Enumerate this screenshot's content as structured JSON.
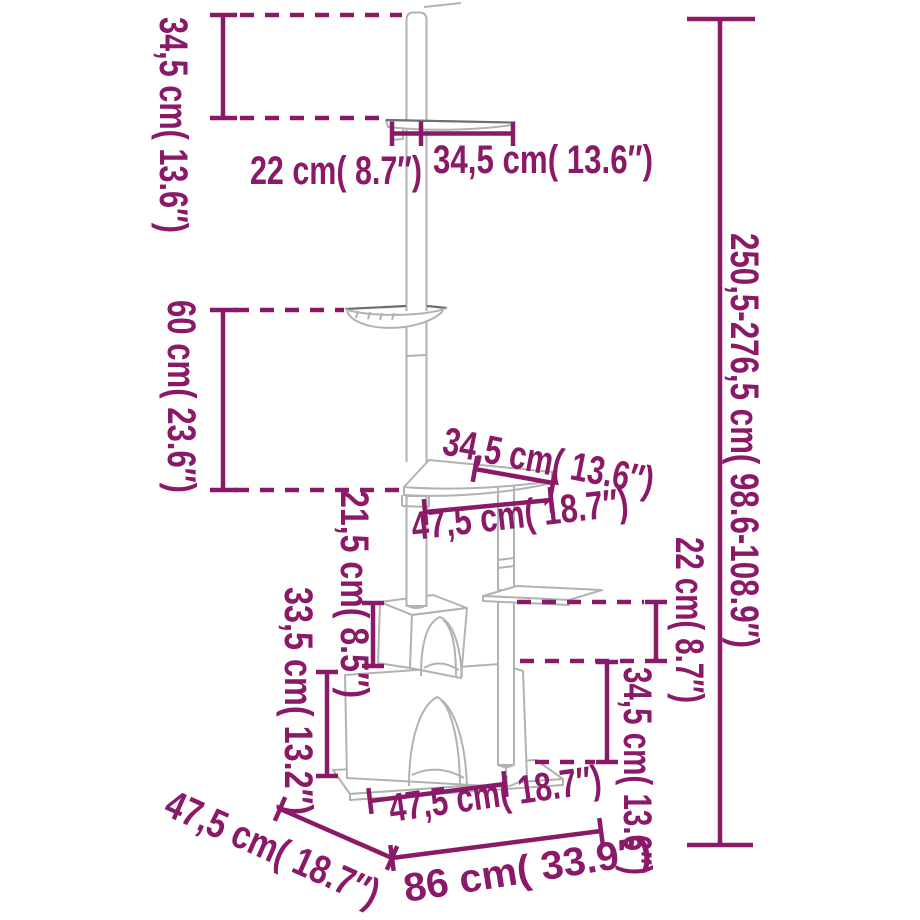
{
  "diagram_title": "floor-to-ceiling cat tree dimensions",
  "colors": {
    "accent": "#8a1a68",
    "product_line": "#b2b2b2",
    "product_line_dark": "#6e6e6e",
    "background": "#ffffff"
  },
  "dimensions": {
    "ceiling_offset": "34,5 cm( 13.6″)",
    "top_shelf_depth": "22 cm( 8.7″)",
    "top_shelf_width": "34,5 cm( 13.6″)",
    "overall_height": "250,5-276,5 cm( 98.6-108.9″)",
    "hammock_to_shelf": "60 cm( 23.6″)",
    "mid_shelf_width": "34,5 cm( 13.6″)",
    "mid_shelf_depth": "47,5 cm( 18.7″)",
    "small_house_height": "21,5 cm( 8.5″)",
    "big_house_height": "33,5 cm( 13.2″)",
    "right_shelf_to_house": "22 cm( 8.7″)",
    "right_house_to_base": "34,5 cm( 13.6″)",
    "base_front_width": "47,5 cm( 18.7″)",
    "base_total_width": "86 cm( 33.9″)",
    "base_depth": "47,5 cm( 18.7″)"
  }
}
